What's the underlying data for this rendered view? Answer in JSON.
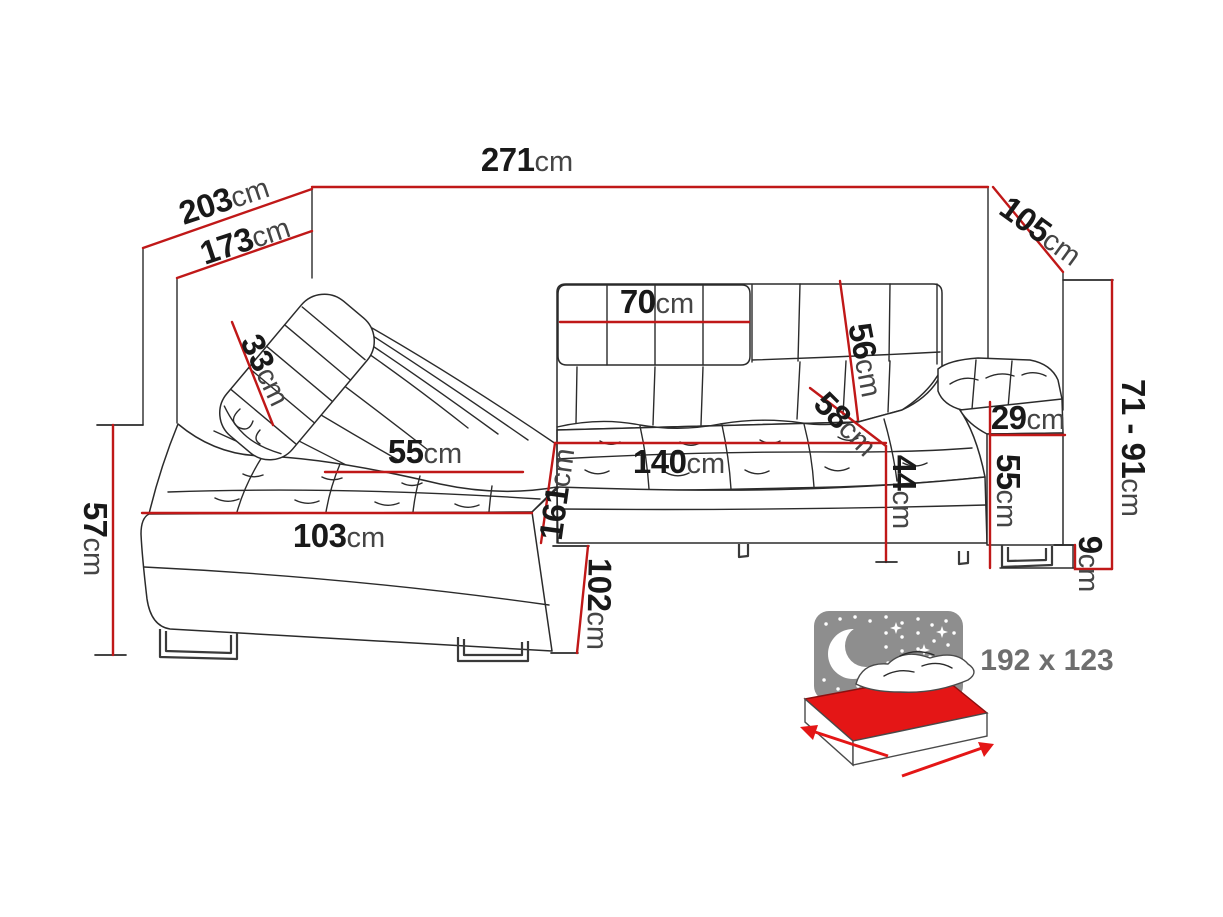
{
  "diagram": {
    "title": "corner-sofa-dimensions",
    "unit": "cm",
    "dims": {
      "d271": {
        "value": "271",
        "unit": "cm"
      },
      "d203": {
        "value": "203",
        "unit": "cm"
      },
      "d173": {
        "value": "173",
        "unit": "cm"
      },
      "d105": {
        "value": "105",
        "unit": "cm"
      },
      "d71_91": {
        "value": "71 - 91",
        "unit": "cm"
      },
      "d70": {
        "value": "70",
        "unit": "cm"
      },
      "d33": {
        "value": "33",
        "unit": "cm"
      },
      "d56": {
        "value": "56",
        "unit": "cm"
      },
      "d58": {
        "value": "58",
        "unit": "cm"
      },
      "d29": {
        "value": "29",
        "unit": "cm"
      },
      "d55_arm": {
        "value": "55",
        "unit": "cm"
      },
      "d44": {
        "value": "44",
        "unit": "cm"
      },
      "d140": {
        "value": "140",
        "unit": "cm"
      },
      "d55_seat": {
        "value": "55",
        "unit": "cm"
      },
      "d103": {
        "value": "103",
        "unit": "cm"
      },
      "d161": {
        "value": "161",
        "unit": "cm"
      },
      "d102": {
        "value": "102",
        "unit": "cm"
      },
      "d57": {
        "value": "57",
        "unit": "cm"
      },
      "d9": {
        "value": "9",
        "unit": "cm"
      }
    },
    "sleeping_area": {
      "label": "192 x 123"
    },
    "colors": {
      "dimension_red": "#c01818",
      "sketch_line": "#2b2b2b",
      "number_text": "#191919",
      "unit_text": "#454545",
      "icon_gray": "#8e8e8e",
      "bed_red": "#e41616",
      "bed_label_gray": "#6e6e6e"
    }
  }
}
